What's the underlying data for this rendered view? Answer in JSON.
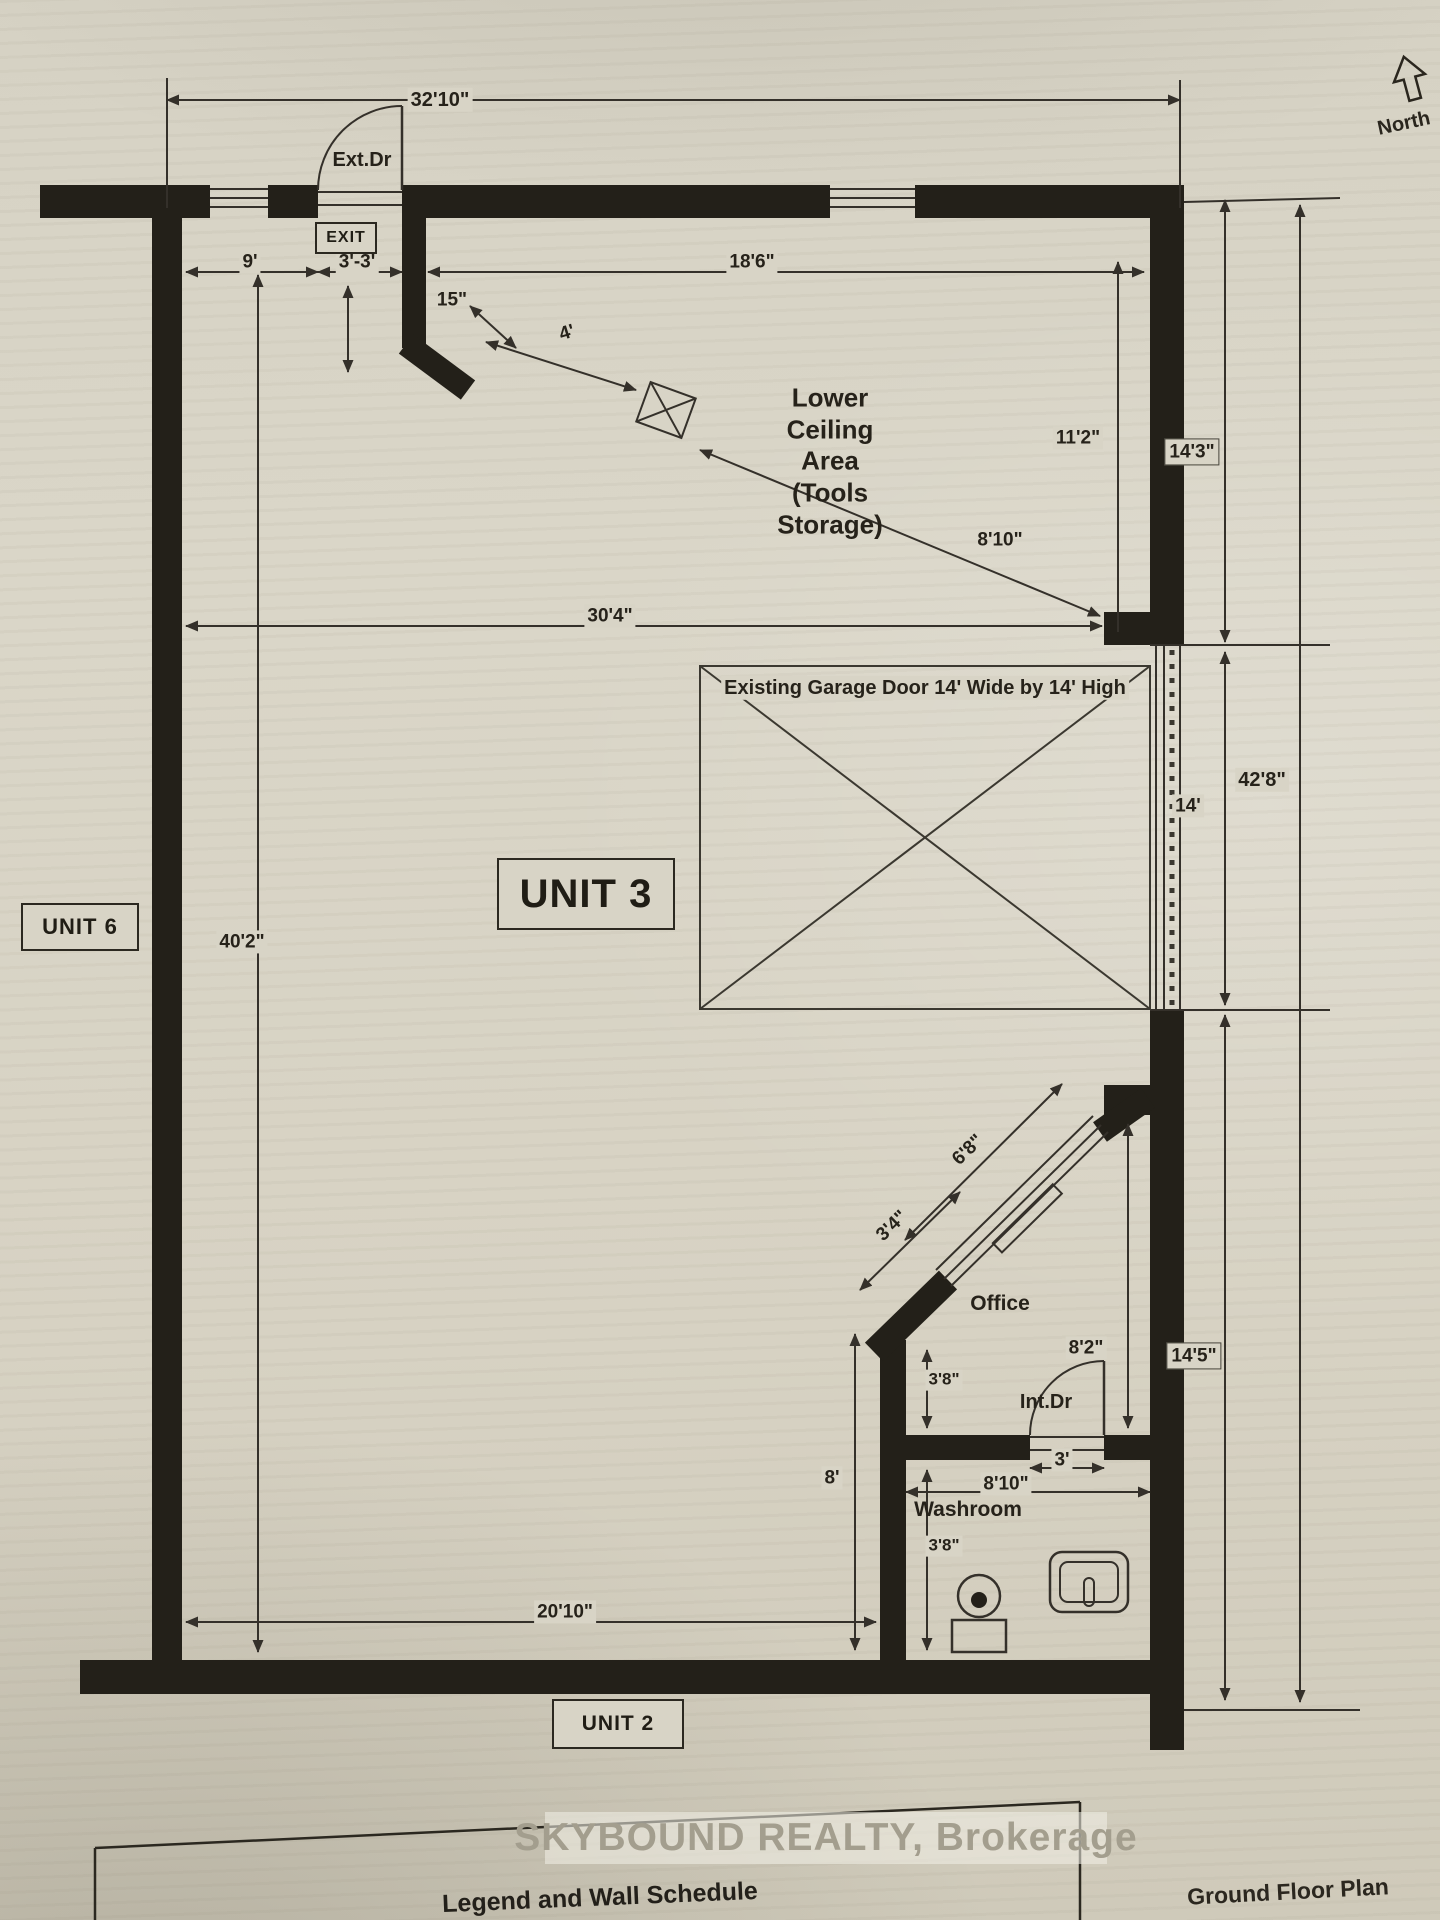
{
  "page": {
    "paper_color": "#d9d5c7",
    "ink_color": "#34302a",
    "wall_color": "#232019",
    "north_label": "North",
    "watermark": "SKYBOUND REALTY, Brokerage",
    "legend_title": "Legend and Wall Schedule",
    "footer_title": "Ground Floor Plan"
  },
  "doors": {
    "exterior": "Ext.Dr",
    "interior": "Int.Dr",
    "exit_sign": "EXIT"
  },
  "rooms": {
    "unit3": "UNIT 3",
    "unit6": "UNIT 6",
    "unit2": "UNIT 2",
    "office": "Office",
    "washroom": "Washroom",
    "tools_area": "Lower\nCeiling\nArea\n(Tools\nStorage)",
    "garage_note": "Existing Garage Door 14' Wide by 14' High"
  },
  "labels": [
    {
      "name": "dim-32-10",
      "text": "32'10\"",
      "x": 440,
      "y": 100,
      "s": 20
    },
    {
      "name": "label-ext-dr",
      "text": "Ext.Dr",
      "x": 362,
      "y": 160,
      "s": 20,
      "bg": false
    },
    {
      "name": "dim-9",
      "text": "9'",
      "x": 250,
      "y": 262,
      "s": 19
    },
    {
      "name": "dim-3-3",
      "text": "3'-3'",
      "x": 357,
      "y": 262,
      "s": 19
    },
    {
      "name": "dim-15",
      "text": "15\"",
      "x": 452,
      "y": 300,
      "s": 19,
      "bg": false
    },
    {
      "name": "dim-4",
      "text": "4'",
      "x": 567,
      "y": 333,
      "s": 19,
      "r": -17,
      "bg": false
    },
    {
      "name": "dim-18-6",
      "text": "18'6\"",
      "x": 752,
      "y": 262,
      "s": 19
    },
    {
      "name": "label-lower-ceiling",
      "text": "Lower\nCeiling\nArea\n(Tools\nStorage)",
      "x": 830,
      "y": 462,
      "s": 26,
      "bg": false
    },
    {
      "name": "dim-8-10-diagonal",
      "text": "8'10\"",
      "x": 1000,
      "y": 540,
      "s": 19,
      "bg": false
    },
    {
      "name": "dim-11-2",
      "text": "11'2\"",
      "x": 1078,
      "y": 438,
      "s": 19
    },
    {
      "name": "dim-14-3",
      "text": "14'3\"",
      "x": 1192,
      "y": 452,
      "s": 19,
      "framed": true
    },
    {
      "name": "dim-30-4",
      "text": "30'4\"",
      "x": 610,
      "y": 616,
      "s": 19
    },
    {
      "name": "label-garage",
      "text": "Existing Garage Door 14' Wide by 14' High",
      "x": 925,
      "y": 688,
      "s": 20
    },
    {
      "name": "dim-14",
      "text": "14'",
      "x": 1188,
      "y": 806,
      "s": 19
    },
    {
      "name": "dim-42-8",
      "text": "42'8\"",
      "x": 1262,
      "y": 780,
      "s": 20
    },
    {
      "name": "dim-40-2",
      "text": "40'2\"",
      "x": 242,
      "y": 942,
      "s": 19
    },
    {
      "name": "dim-6-8",
      "text": "6'8\"",
      "x": 968,
      "y": 1150,
      "s": 19,
      "r": -44,
      "bg": false
    },
    {
      "name": "dim-3-4",
      "text": "3'4\"",
      "x": 892,
      "y": 1226,
      "s": 19,
      "r": -44,
      "bg": false
    },
    {
      "name": "label-office",
      "text": "Office",
      "x": 1000,
      "y": 1304,
      "s": 21,
      "bg": false
    },
    {
      "name": "dim-8-2",
      "text": "8'2\"",
      "x": 1086,
      "y": 1348,
      "s": 19
    },
    {
      "name": "dim-14-5",
      "text": "14'5\"",
      "x": 1194,
      "y": 1356,
      "s": 19,
      "framed": true
    },
    {
      "name": "label-int-dr",
      "text": "Int.Dr",
      "x": 1046,
      "y": 1402,
      "s": 20,
      "bg": false
    },
    {
      "name": "dim-3",
      "text": "3'",
      "x": 1062,
      "y": 1460,
      "s": 19
    },
    {
      "name": "dim-8-10-washroom",
      "text": "8'10\"",
      "x": 1006,
      "y": 1484,
      "s": 19
    },
    {
      "name": "label-washroom",
      "text": "Washroom",
      "x": 968,
      "y": 1510,
      "s": 21,
      "bg": false
    },
    {
      "name": "dim-3-8-upper",
      "text": "3'8\"",
      "x": 944,
      "y": 1380,
      "s": 17
    },
    {
      "name": "dim-3-8-lower",
      "text": "3'8\"",
      "x": 944,
      "y": 1546,
      "s": 17
    },
    {
      "name": "dim-8",
      "text": "8'",
      "x": 832,
      "y": 1478,
      "s": 19
    },
    {
      "name": "dim-20-10",
      "text": "20'10\"",
      "x": 565,
      "y": 1612,
      "s": 19
    }
  ],
  "boxes": [
    {
      "name": "exit-sign",
      "text": "EXIT",
      "x": 346,
      "y": 238,
      "w": 58,
      "h": 28,
      "s": 16
    },
    {
      "name": "unit-3-label",
      "text": "UNIT 3",
      "x": 586,
      "y": 894,
      "w": 174,
      "h": 68,
      "s": 40
    },
    {
      "name": "unit-6-label",
      "text": "UNIT 6",
      "x": 80,
      "y": 927,
      "w": 114,
      "h": 44,
      "s": 22
    },
    {
      "name": "unit-2-label",
      "text": "UNIT 2",
      "x": 618,
      "y": 1724,
      "w": 128,
      "h": 46,
      "s": 21
    }
  ]
}
